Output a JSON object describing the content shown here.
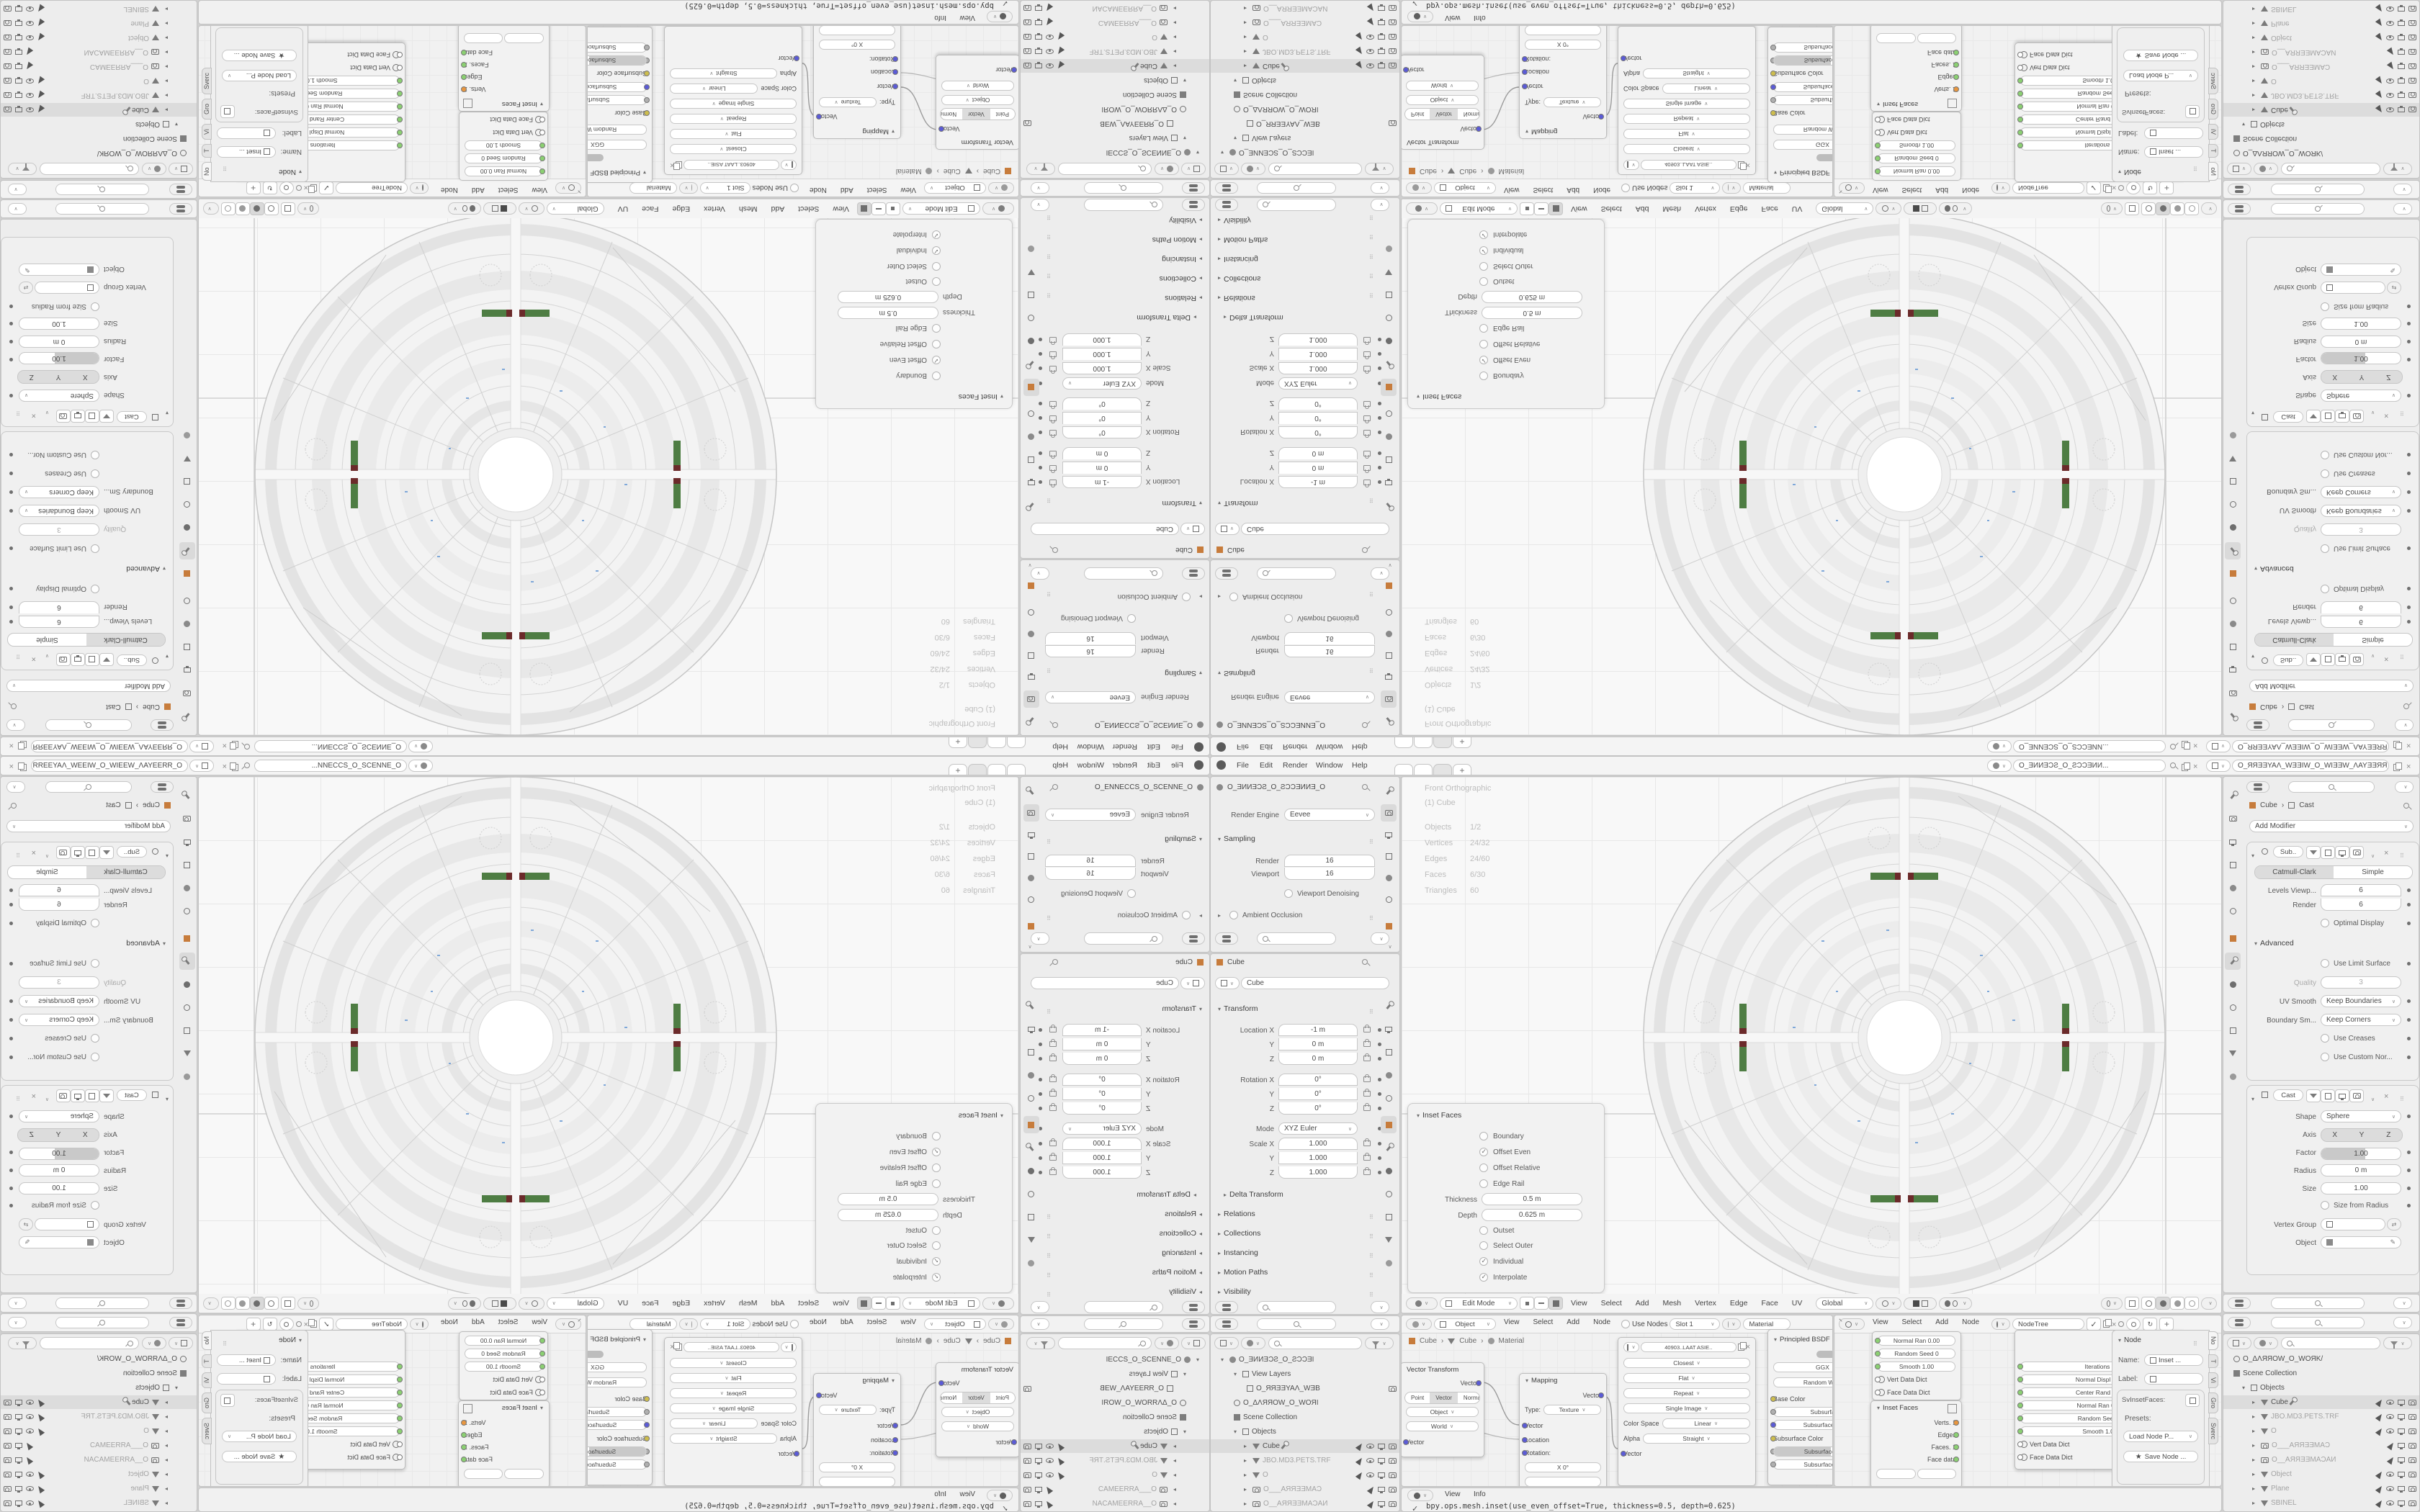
{
  "colors": {
    "accent_green": "#4e7d43",
    "accent_maroon": "#6b2a2a",
    "socket_green": "#8bd072",
    "socket_orange": "#e8963f",
    "socket_blue": "#5b5bd6",
    "socket_yellow": "#cdbd4e",
    "selection_grey": "#dcdcdc",
    "header_bg": "#f4f4f4"
  },
  "q": {
    "topbar": {
      "menus": [
        "File",
        "Edit",
        "Render",
        "Window",
        "Help"
      ],
      "tab_plus": "+",
      "scene_name": "O_ƎИИƎƆƧ_O_ƧƆƆƎИИ...",
      "view_layer_name": "O_ЯЯƎƎYAΛ_WƎƎIW_O_WIƎƎW_ΛAYƎƎЯЯ_O"
    },
    "props_render": {
      "scene_name": "O_ƎИИƎƆƧ_O_ƧƆƆƎИИƎ_O",
      "engine_label": "Render Engine",
      "engine": "Eevee",
      "sampling": "Sampling",
      "render_label": "Render",
      "render_value": "16",
      "viewport_label": "Viewport",
      "viewport_value": "16",
      "denoising": "Viewport Denoising",
      "ao": "Ambient Occlusion"
    },
    "props_object": {
      "crumb": "Cube",
      "name": "Cube",
      "transform": "Transform",
      "loc": [
        {
          "l": "Location X",
          "v": "-1 m"
        },
        {
          "l": "Y",
          "v": "0 m"
        },
        {
          "l": "Z",
          "v": "0 m"
        }
      ],
      "rot": [
        {
          "l": "Rotation X",
          "v": "0°"
        },
        {
          "l": "Y",
          "v": "0°"
        },
        {
          "l": "Z",
          "v": "0°"
        }
      ],
      "mode_label": "Mode",
      "mode": "XYZ Euler",
      "scale": [
        {
          "l": "Scale X",
          "v": "1.000"
        },
        {
          "l": "Y",
          "v": "1.000"
        },
        {
          "l": "Z",
          "v": "1.000"
        }
      ],
      "sections": [
        "Delta Transform",
        "Relations",
        "Collections",
        "Instancing",
        "Motion Paths",
        "Visibility"
      ]
    },
    "outliner_left": {
      "rows": [
        {
          "t": "O_ƎИИƎƆƧ_O_ƧƆƆƎI"
        },
        {
          "t": "View Layers"
        },
        {
          "t": "O_ЯЯƎƎYAΛ_WƎB"
        },
        {
          "t": "O_ΔΛЯЯOW_O_WOЯI"
        },
        {
          "t": "Scene Collection"
        },
        {
          "t": "Objects"
        },
        {
          "t": "Cube"
        },
        {
          "t": "JBO.MD3.PETS.TRF"
        },
        {
          "t": "O"
        },
        {
          "t": "O___AЯЯƎƎMAƆ"
        },
        {
          "t": "O__AЯЯƎƎMAƆAИ"
        }
      ]
    },
    "outliner_right": {
      "rows": [
        {
          "t": "O_ΔΛЯЯOW_O_WOЯK/"
        },
        {
          "t": "Scene Collection"
        },
        {
          "t": "Objects"
        },
        {
          "t": "Cube"
        },
        {
          "t": "JBO.MD3.PETS.TRF"
        },
        {
          "t": "O"
        },
        {
          "t": "O___AЯЯƎƎMAƆ"
        },
        {
          "t": "O__AЯЯƎƎMAƆAИ"
        },
        {
          "t": "Object"
        },
        {
          "t": "Plane"
        },
        {
          "t": "SBINEL"
        }
      ]
    },
    "viewport": {
      "overlay1": "Front Orthographic",
      "overlay2": "(1) Cube",
      "stats": [
        {
          "l": "Objects",
          "v": "1/2"
        },
        {
          "l": "Vertices",
          "v": "24/32"
        },
        {
          "l": "Edges",
          "v": "24/60"
        },
        {
          "l": "Faces",
          "v": "6/30"
        },
        {
          "l": "Triangles",
          "v": "60"
        }
      ],
      "mode": "Edit Mode",
      "menus": [
        "View",
        "Select",
        "Add",
        "Mesh",
        "Vertex",
        "Edge",
        "Face",
        "UV"
      ],
      "orientation": "Global"
    },
    "inset": {
      "title": "Inset Faces",
      "checks1": [
        {
          "l": "Boundary",
          "on": false
        },
        {
          "l": "Offset Even",
          "on": true
        },
        {
          "l": "Offset Relative",
          "on": false
        },
        {
          "l": "Edge Rail",
          "on": false
        }
      ],
      "fields": [
        {
          "l": "Thickness",
          "v": "0.5 m"
        },
        {
          "l": "Depth",
          "v": "0.625 m"
        }
      ],
      "checks2": [
        {
          "l": "Outset",
          "on": false
        },
        {
          "l": "Select Outer",
          "on": false
        },
        {
          "l": "Individual",
          "on": true
        },
        {
          "l": "Interpolate",
          "on": true
        }
      ]
    },
    "shader": {
      "type": "Object",
      "menus": [
        "View",
        "Select",
        "Add",
        "Node"
      ],
      "use_nodes": "Use Nodes",
      "slot": "Slot 1",
      "material": "Material",
      "crumb": [
        "Cube",
        "Cube",
        "Material"
      ],
      "vt": {
        "title": "Vector Transform",
        "out": "Vector",
        "seg": [
          "Point",
          "Vector",
          "Normal"
        ],
        "dd1": "Object",
        "dd2": "World",
        "inp": "Vector"
      },
      "map": {
        "title": "Mapping",
        "out": "Vector",
        "type_label": "Type:",
        "type": "Texture",
        "ins": [
          "Vector",
          "Location",
          "Rotation:"
        ],
        "x_label": "X",
        "x_value": "0°"
      },
      "img": {
        "datablock": "40903..LAAT ASIE..",
        "dds": [
          "Closest",
          "Flat",
          "Repeat",
          "Single Image"
        ],
        "cs_label": "Color Space",
        "cs": "Linear",
        "alpha_label": "Alpha",
        "alpha": "Straight",
        "inp": "Vector"
      },
      "bsdf": {
        "title": "Principled BSDF",
        "dds": [
          "GGX",
          "Random Walk"
        ],
        "rows": [
          {
            "l": "Base Color"
          },
          {
            "l": "Subsurface"
          },
          {
            "l": "Subsurface Radi"
          },
          {
            "l": "Subsurface Color"
          },
          {
            "l": "Subsurface IOR"
          },
          {
            "l": "Subsurface Anis"
          }
        ]
      }
    },
    "sverchok": {
      "menus": [
        "View",
        "Select",
        "Add",
        "Node"
      ],
      "tree": "NodeTree",
      "n1": {
        "rows": [
          {
            "l": "Normal Ran",
            "v": "0.00"
          },
          {
            "l": "Random Seed",
            "v": "0"
          },
          {
            "l": "Smooth",
            "v": "1.00"
          }
        ],
        "dicts": [
          "Vert Data Dict",
          "Face Data Dict"
        ]
      },
      "n2": {
        "title": "Inset Faces",
        "outs": [
          "Verts. 1",
          "Edges",
          "Faces. 1",
          "Face data"
        ]
      },
      "n3": {
        "outs": [
          "Vertices. 1",
          "Polygons. 1"
        ],
        "ins": [
          {
            "l": "Iterations",
            "v": "3"
          },
          {
            "l": "Normal Displ",
            "v": "0.00"
          },
          {
            "l": "Center Rand",
            "v": "0.00"
          },
          {
            "l": "Normal Ran",
            "v": "0.00"
          },
          {
            "l": "Random Seed",
            "v": "0"
          },
          {
            "l": "Smooth",
            "v": "1.00"
          }
        ],
        "dicts": [
          "Vert Data Dict",
          "Face Data Dict"
        ]
      },
      "npanel": {
        "title": "Node",
        "name_label": "Name:",
        "name": "Inset ...",
        "label_label": "Label:",
        "group": "SvInsetFaces:",
        "presets": "Presets:",
        "load": "Load Node P...",
        "save": "Save Node ...",
        "tabs": [
          "No",
          "T",
          "Vi",
          "Gro",
          "Sverc"
        ]
      }
    },
    "info": {
      "menus": [
        "View",
        "Info"
      ],
      "line": "bpy.ops.mesh.inset(use_even_offset=True, thickness=0.5, depth=0.625)"
    },
    "mods": {
      "header_scene": "ИИƎƆƧ_O_ƧƆƆƎИИ...",
      "header_layer": "O_ЯЯƎƎYAΛ_WƎƎIW_O_WIƎƎW_ΛAYƎƎЯЯ_O",
      "crumb": [
        "Cube",
        "Cast"
      ],
      "add": "Add Modifier",
      "sub": {
        "name": "Sub..",
        "seg": [
          "Catmull-Clark",
          "Simple"
        ],
        "levels": {
          "l": "Levels Viewp...",
          "v": "6"
        },
        "render": {
          "l": "Render",
          "v": "6"
        },
        "optimal": "Optimal Display",
        "advanced": "Advanced",
        "limit": "Use Limit Surface",
        "quality": {
          "l": "Quality",
          "v": "3"
        },
        "uv": {
          "l": "UV Smooth",
          "v": "Keep Boundaries"
        },
        "bs": {
          "l": "Boundary Sm...",
          "v": "Keep Corners"
        },
        "creases": "Use Creases",
        "normals": "Use Custom Nor..."
      },
      "cast": {
        "name": "Cast",
        "shape": {
          "l": "Shape",
          "v": "Sphere"
        },
        "axis_label": "Axis",
        "axis": [
          "X",
          "Y",
          "Z"
        ],
        "factor": {
          "l": "Factor",
          "v": "1.00"
        },
        "radius": {
          "l": "Radius",
          "v": "0 m"
        },
        "size": {
          "l": "Size",
          "v": "1.00"
        },
        "sfr": "Size from Radius",
        "vg": "Vertex Group",
        "obj": "Object"
      }
    }
  }
}
